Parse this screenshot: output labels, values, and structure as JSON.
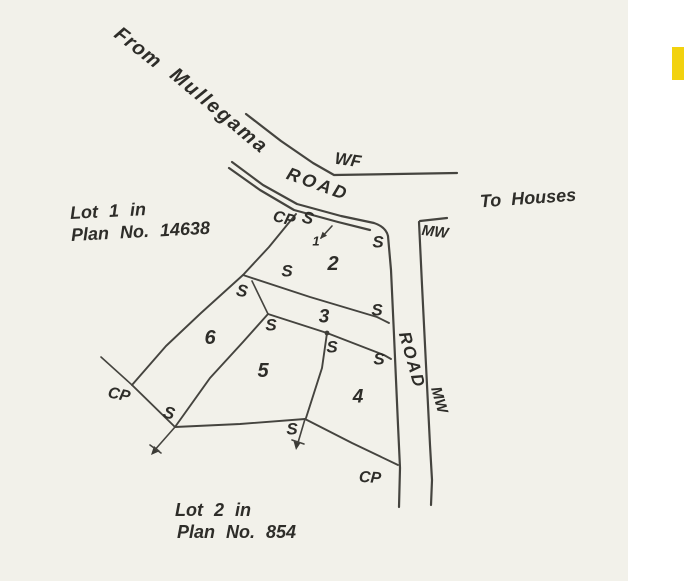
{
  "colors": {
    "paper": "#f2f1ea",
    "margin_white": "#ffffff",
    "ink": "#45443f",
    "text_ink": "#2e2d29",
    "highlight": "#f2d20e"
  },
  "plan": {
    "notes": {
      "lot1_line1": "Lot 1 in",
      "lot1_line2": "Plan No. 14638",
      "lot2_line1": "Lot 2 in",
      "lot2_line2": "Plan No. 854"
    },
    "road_labels": {
      "from": "From",
      "place": "Mullegama",
      "wf": "WF",
      "road_top": "ROAD",
      "to_houses": "To Houses",
      "mw_top": "MW",
      "road_side": "ROAD",
      "mw_side": "MW"
    },
    "parcel_labels": {
      "p1": "1",
      "p2": "2",
      "p3": "3",
      "p4": "4",
      "p5": "5",
      "p6": "6"
    },
    "survey_marks": {
      "cp": "CP",
      "s": "S"
    }
  }
}
